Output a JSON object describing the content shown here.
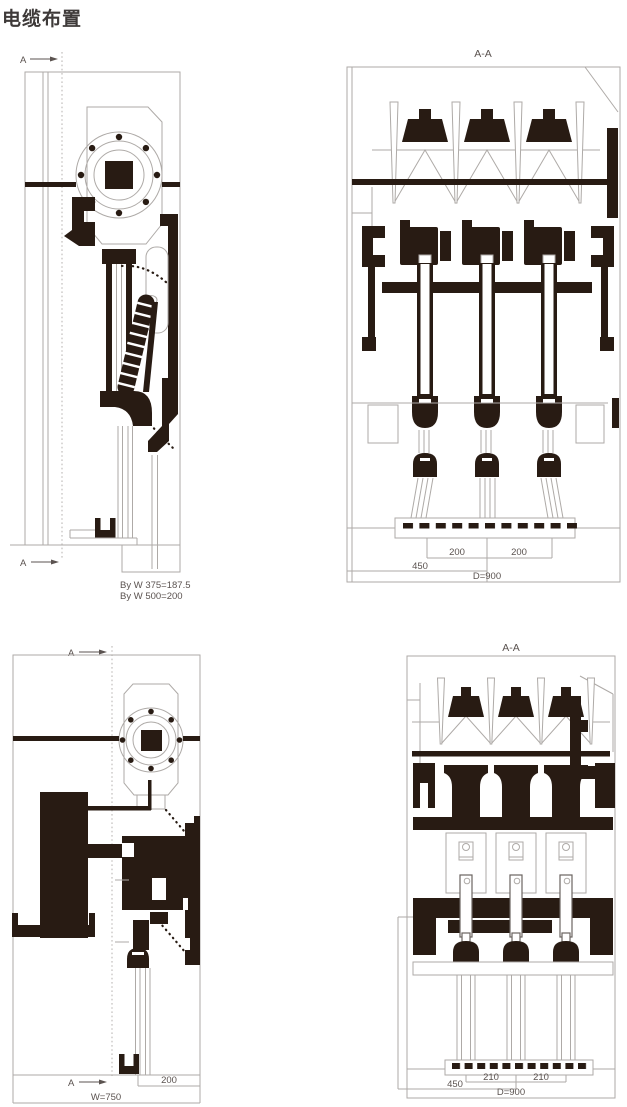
{
  "title": "电缆布置",
  "colors": {
    "ink": "#281b13",
    "line": "#aeaaa7",
    "text": "#5b5350",
    "title": "#3e3a39"
  },
  "panels": {
    "top_left": {
      "marker_top": "A",
      "marker_bottom": "A",
      "notes": {
        "line1": "By W 375=187.5",
        "line2": "By W 500=200"
      }
    },
    "top_right": {
      "label": "A-A",
      "dims": {
        "left": "200",
        "right": "200",
        "half": "450",
        "depth": "D=900"
      }
    },
    "bottom_left": {
      "marker_top": "A",
      "marker_bottom": "A",
      "dims": {
        "offset": "200",
        "width": "W=750"
      }
    },
    "bottom_right": {
      "label": "A-A",
      "dims": {
        "left": "210",
        "right": "210",
        "half": "450",
        "depth": "D=900"
      }
    }
  }
}
